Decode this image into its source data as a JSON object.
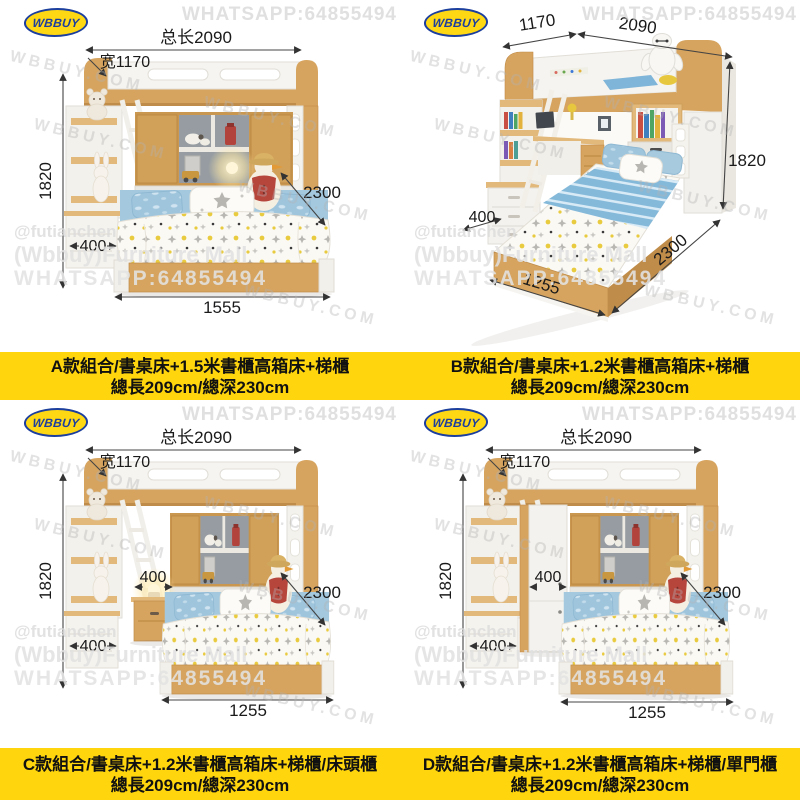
{
  "brand": {
    "logo_text": "WBBUY"
  },
  "watermarks": {
    "whatsapp": "WHATSAPP:64855494",
    "site": "WBBUY.COM",
    "handle": "@futianchen",
    "mall": "(Wbbuy)Furniture Mall"
  },
  "colors": {
    "caption_bg": "#FFD60E",
    "logo_blue": "#1C3F9E",
    "logo_yellow": "#FFD814",
    "wood": "#D6A45F",
    "bedding_blue": "#9FC5DD",
    "dim_text": "#1A1A1A"
  },
  "panels": {
    "a": {
      "dims": {
        "total_length": "总长2090",
        "width": "宽1170",
        "height": "1820",
        "stair_depth": "400",
        "bed_length": "1555",
        "total_depth": "2300"
      },
      "caption_line1": "A款組合/書桌床+1.5米書櫃高箱床+梯櫃",
      "caption_line2": "總長209cm/總深230cm"
    },
    "b": {
      "dims": {
        "width": "1170",
        "total_length": "2090",
        "height": "1820",
        "stair_depth": "400",
        "bed_length": "1255",
        "total_depth": "2300"
      },
      "caption_line1": "B款組合/書桌床+1.2米書櫃高箱床+梯櫃",
      "caption_line2": "總長209cm/總深230cm"
    },
    "c": {
      "dims": {
        "total_length": "总长2090",
        "width": "宽1170",
        "height": "1820",
        "cabinet_width": "400",
        "stair_depth": "400",
        "bed_length": "1255",
        "total_depth": "2300"
      },
      "caption_line1": "C款組合/書桌床+1.2米書櫃高箱床+梯櫃/床頭櫃",
      "caption_line2": "總長209cm/總深230cm"
    },
    "d": {
      "dims": {
        "total_length": "总长2090",
        "width": "宽1170",
        "height": "1820",
        "cabinet_width": "400",
        "stair_depth": "400",
        "bed_length": "1255",
        "total_depth": "2300"
      },
      "caption_line1": "D款組合/書桌床+1.2米書櫃高箱床+梯櫃/單門櫃",
      "caption_line2": "總長209cm/總深230cm"
    }
  }
}
